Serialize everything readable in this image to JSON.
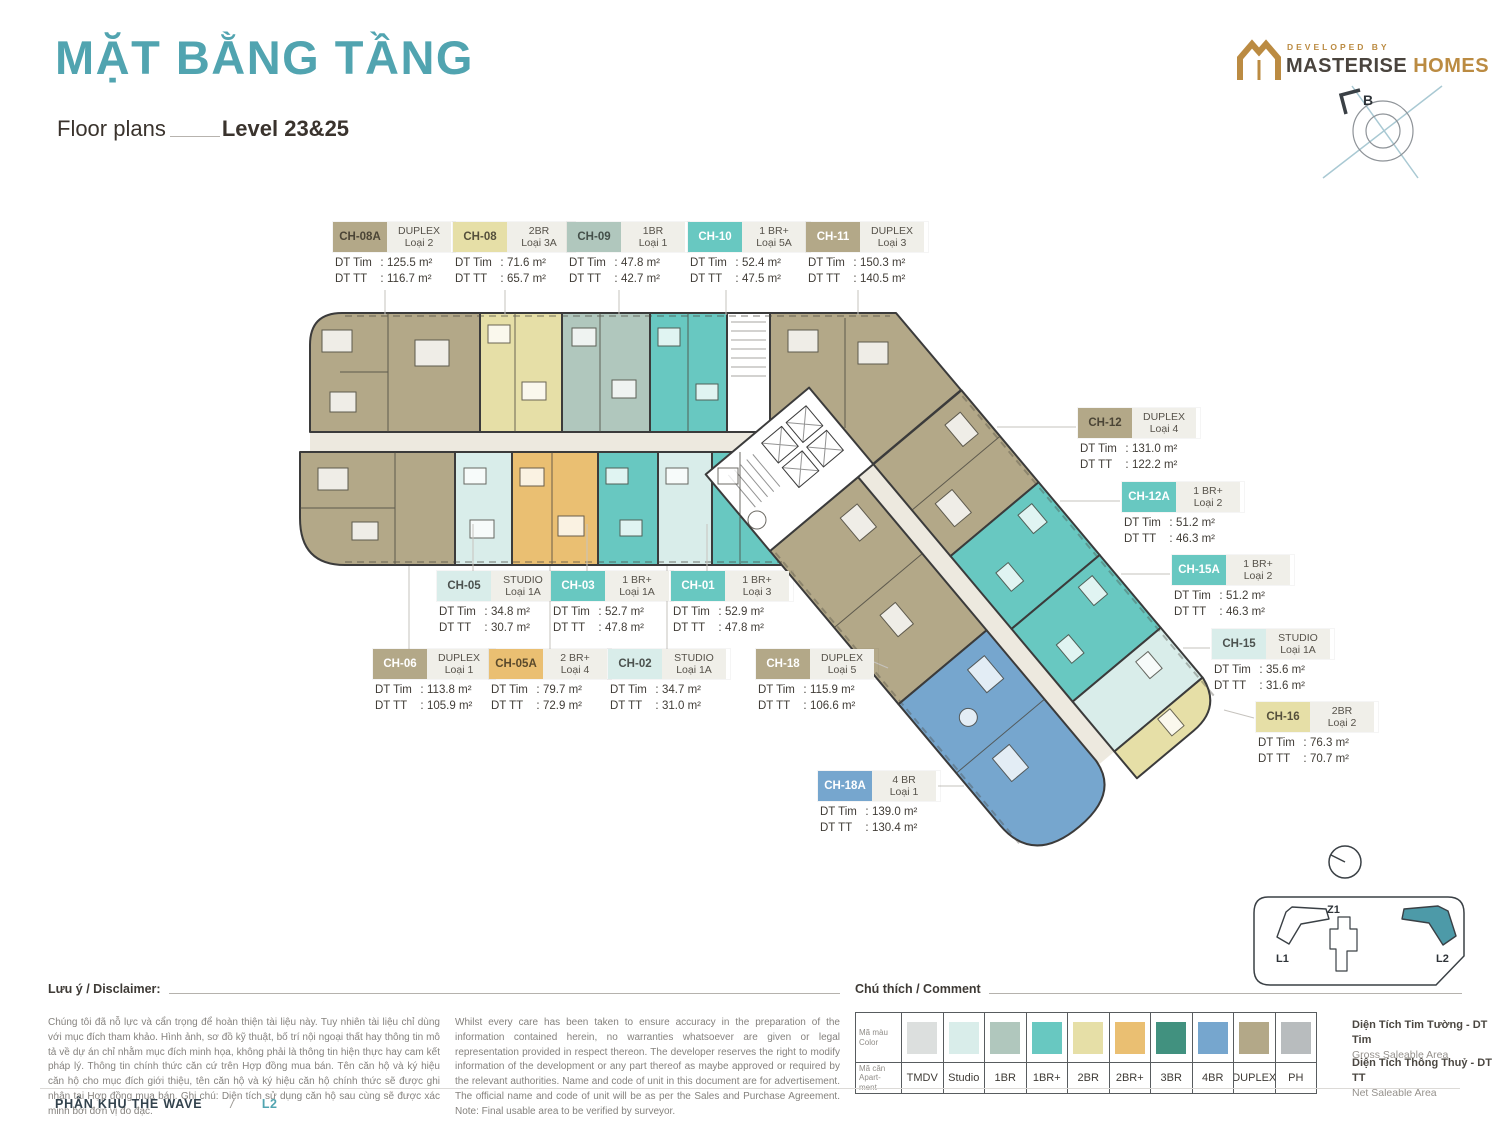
{
  "page": {
    "title": "MẶT BẰNG TẦNG",
    "subtitle": "Floor plans",
    "level": "Level 23&25"
  },
  "developer": {
    "tagline": "DEVELOPED BY",
    "name_primary": "MASTERISE",
    "name_secondary": "HOMES"
  },
  "compass": {
    "north_label": "B"
  },
  "strings": {
    "dt_tim": "DT Tim",
    "dt_tt": "DT TT",
    "colon": ":"
  },
  "units": [
    {
      "code": "CH-08A",
      "type": "DUPLEX",
      "variant": "Loại 2",
      "dt_tim": "125.5 m²",
      "dt_tt": "116.7 m²",
      "color": "#b3a888",
      "fg": "#4b4536"
    },
    {
      "code": "CH-08",
      "type": "2BR",
      "variant": "Loại 3A",
      "dt_tim": "71.6 m²",
      "dt_tt": "65.7 m²",
      "color": "#e6dfa7",
      "fg": "#55503c"
    },
    {
      "code": "CH-09",
      "type": "1BR",
      "variant": "Loại 1",
      "dt_tim": "47.8 m²",
      "dt_tt": "42.7 m²",
      "color": "#b0c7bd",
      "fg": "#44504a"
    },
    {
      "code": "CH-10",
      "type": "1 BR+",
      "variant": "Loại 5A",
      "dt_tim": "52.4 m²",
      "dt_tt": "47.5 m²",
      "color": "#68c8c1",
      "fg": "#ffffff"
    },
    {
      "code": "CH-11",
      "type": "DUPLEX",
      "variant": "Loại 3",
      "dt_tim": "150.3 m²",
      "dt_tt": "140.5 m²",
      "color": "#b3a888",
      "fg": "#ffffff"
    },
    {
      "code": "CH-12",
      "type": "DUPLEX",
      "variant": "Loại 4",
      "dt_tim": "131.0 m²",
      "dt_tt": "122.2 m²",
      "color": "#b3a888",
      "fg": "#4b4536"
    },
    {
      "code": "CH-12A",
      "type": "1 BR+",
      "variant": "Loại 2",
      "dt_tim": "51.2 m²",
      "dt_tt": "46.3 m²",
      "color": "#68c8c1",
      "fg": "#ffffff"
    },
    {
      "code": "CH-15A",
      "type": "1 BR+",
      "variant": "Loại 2",
      "dt_tim": "51.2 m²",
      "dt_tt": "46.3 m²",
      "color": "#68c8c1",
      "fg": "#ffffff"
    },
    {
      "code": "CH-15",
      "type": "STUDIO",
      "variant": "Loại 1A",
      "dt_tim": "35.6 m²",
      "dt_tt": "31.6 m²",
      "color": "#d9edea",
      "fg": "#4c524f"
    },
    {
      "code": "CH-16",
      "type": "2BR",
      "variant": "Loại 2",
      "dt_tim": "76.3 m²",
      "dt_tt": "70.7 m²",
      "color": "#e6dfa7",
      "fg": "#55503c"
    },
    {
      "code": "CH-05",
      "type": "STUDIO",
      "variant": "Loại 1A",
      "dt_tim": "34.8 m²",
      "dt_tt": "30.7 m²",
      "color": "#d9edea",
      "fg": "#4c524f"
    },
    {
      "code": "CH-03",
      "type": "1 BR+",
      "variant": "Loại 1A",
      "dt_tim": "52.7 m²",
      "dt_tt": "47.8 m²",
      "color": "#68c8c1",
      "fg": "#ffffff"
    },
    {
      "code": "CH-01",
      "type": "1 BR+",
      "variant": "Loại 3",
      "dt_tim": "52.9 m²",
      "dt_tt": "47.8 m²",
      "color": "#68c8c1",
      "fg": "#ffffff"
    },
    {
      "code": "CH-06",
      "type": "DUPLEX",
      "variant": "Loại 1",
      "dt_tim": "113.8 m²",
      "dt_tt": "105.9 m²",
      "color": "#b3a888",
      "fg": "#ffffff"
    },
    {
      "code": "CH-05A",
      "type": "2 BR+",
      "variant": "Loại 4",
      "dt_tim": "79.7 m²",
      "dt_tt": "72.9 m²",
      "color": "#eabf72",
      "fg": "#5a4a2c"
    },
    {
      "code": "CH-02",
      "type": "STUDIO",
      "variant": "Loại 1A",
      "dt_tim": "34.7 m²",
      "dt_tt": "31.0 m²",
      "color": "#d9edea",
      "fg": "#4c524f"
    },
    {
      "code": "CH-18",
      "type": "DUPLEX",
      "variant": "Loại 5",
      "dt_tim": "115.9 m²",
      "dt_tt": "106.6 m²",
      "color": "#b3a888",
      "fg": "#ffffff"
    },
    {
      "code": "CH-18A",
      "type": "4 BR",
      "variant": "Loại 1",
      "dt_tim": "139.0 m²",
      "dt_tt": "130.4 m²",
      "color": "#76a6ce",
      "fg": "#ffffff"
    }
  ],
  "legend": {
    "title": "Chú thích / Comment",
    "color_row": {
      "vi": "Mã màu",
      "en": "Color"
    },
    "code_row": {
      "vi": "Mã căn",
      "en": "Apart-ment"
    },
    "items": [
      {
        "code": "TMDV",
        "color": "#dcdfde"
      },
      {
        "code": "Studio",
        "color": "#d9edea"
      },
      {
        "code": "1BR",
        "color": "#b0c7bd"
      },
      {
        "code": "1BR+",
        "color": "#68c8c1"
      },
      {
        "code": "2BR",
        "color": "#e6dfa7"
      },
      {
        "code": "2BR+",
        "color": "#eabf72"
      },
      {
        "code": "3BR",
        "color": "#41917f"
      },
      {
        "code": "4BR",
        "color": "#76a6ce"
      },
      {
        "code": "DUPLEX",
        "color": "#b3a888"
      },
      {
        "code": "PH",
        "color": "#b8bcbe"
      }
    ],
    "definitions": [
      {
        "vi": "Diện Tích Tim Tường - DT Tim",
        "en": "Gross Saleable Area"
      },
      {
        "vi": "Diện Tích Thông Thuỷ - DT TT",
        "en": "Net Saleable Area"
      }
    ]
  },
  "disclaimer": {
    "title": "Lưu ý / Disclaimer:",
    "vi": "Chúng tôi đã nỗ lực và cẩn trọng để hoàn thiện tài liệu này. Tuy nhiên tài liệu chỉ dùng với mục đích tham khảo. Hình ảnh, sơ đồ kỹ thuật, bố trí nội ngoại thất hay thông tin mô tả về dự án chỉ nhằm mục đích minh họa, không phải là thông tin hiện thực hay cam kết pháp lý. Thông tin chính thức căn cứ trên Hợp đồng mua bán. Tên căn hộ và ký hiệu căn hộ cho mục đích giới thiệu, tên căn hộ và ký hiệu căn hộ chính thức sẽ được ghi nhận tại Hợp đồng mua bán. Ghi chú: Diện tích sử dụng căn hộ sau cùng sẽ được xác minh bởi đơn vị đo đạc.",
    "en": "Whilst every care has been taken to ensure accuracy in the preparation of the information contained herein, no warranties whatsoever are given or legal representation provided in respect thereon. The developer reserves the right to modify information of the development or any part thereof as maybe approved or required by the relevant authorities. Name and code of unit in this document are for advertisement. The official name and code of unit will be as per the Sales and Purchase Agreement. Note: Final usable area to be verified by surveyor."
  },
  "footer": {
    "zone": "PHÂN KHU THE WAVE",
    "separator": "/",
    "tower": "L2"
  },
  "minimap": {
    "buildings": [
      {
        "label": "L1"
      },
      {
        "label": "Z1"
      },
      {
        "label": "L2"
      }
    ],
    "active": "L2",
    "active_color": "#4d9aa8"
  },
  "colors": {
    "accent": "#51a4b0",
    "gold": "#bb8b42",
    "wall": "#3b3b3b",
    "corridor": "#ede9df",
    "tmdv": "#dcdfde",
    "studio": "#d9edea",
    "br1": "#b0c7bd",
    "br1p": "#68c8c1",
    "br2": "#e6dfa7",
    "br2p": "#eabf72",
    "br3": "#41917f",
    "br4": "#76a6ce",
    "duplex": "#b3a888",
    "ph": "#b8bcbe"
  }
}
